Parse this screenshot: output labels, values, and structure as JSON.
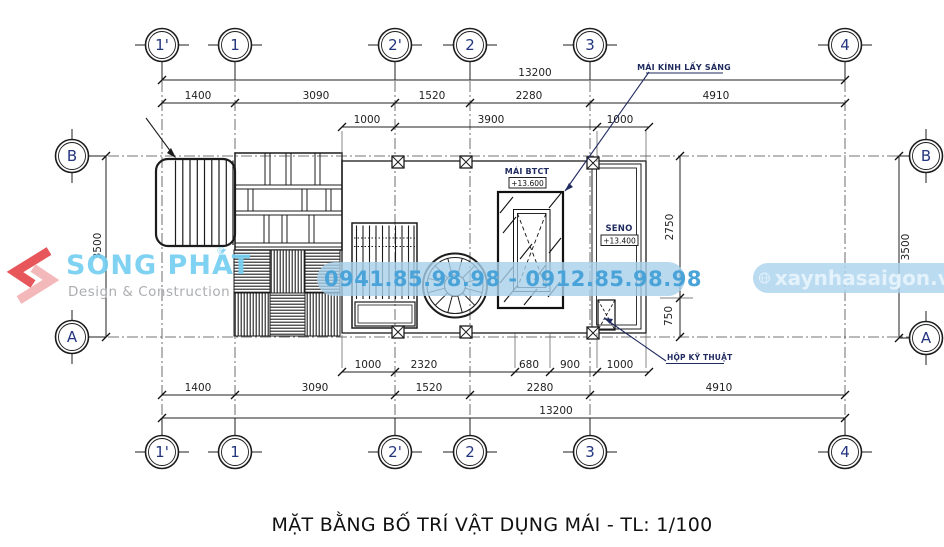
{
  "title": "MẶT BẰNG BỐ TRÍ VẬT DỤNG MÁI - TL: 1/100",
  "grid": {
    "top": [
      "1'",
      "1",
      "2'",
      "2",
      "3",
      "4"
    ],
    "bottom": [
      "1'",
      "1",
      "2'",
      "2",
      "3",
      "4"
    ],
    "left": [
      "B",
      "A"
    ],
    "right": [
      "B",
      "A"
    ]
  },
  "dims": {
    "top_total": "13200",
    "top_row": [
      "1400",
      "3090",
      "1520",
      "2280",
      "4910"
    ],
    "top_sub": [
      "1000",
      "3900",
      "1000"
    ],
    "bottom_sub": [
      "1000",
      "2320",
      "680",
      "900",
      "1000"
    ],
    "bottom_row": [
      "1400",
      "3090",
      "1520",
      "2280",
      "4910"
    ],
    "bottom_total": "13200",
    "left_vert": "3500",
    "right_vert": "3500",
    "right_inner_top": "2750",
    "right_inner_bottom": "750"
  },
  "labels": {
    "skylight": "MÁI KÍNH LẤY SÁNG",
    "roof_slab": "MÁI BTCT",
    "roof_slab_level": "+13.600",
    "gutter": "SENO",
    "gutter_level": "+13.400",
    "tech_box": "HỘP KỸ THUẬT"
  },
  "watermarks": {
    "logo_name": "SONG PHÁT",
    "logo_reg": "®",
    "logo_tagline": "Design & Construction",
    "phone": "0941.85.98.98 - 0912.85.98.98",
    "website": "xaynhasaigon.vn"
  },
  "colors": {
    "line": "#222222",
    "grid_label": "#23357e",
    "label_navy": "#1f2a5e",
    "logo_red": "#e5484d",
    "logo_pink": "#f3b2b4",
    "logo_blue": "#76cff1",
    "tagline_gray": "#a5a7aa",
    "phone_text": "#4aa3d8",
    "band_blue": "#a7cfeb",
    "web_text": "#e4f2fb"
  }
}
